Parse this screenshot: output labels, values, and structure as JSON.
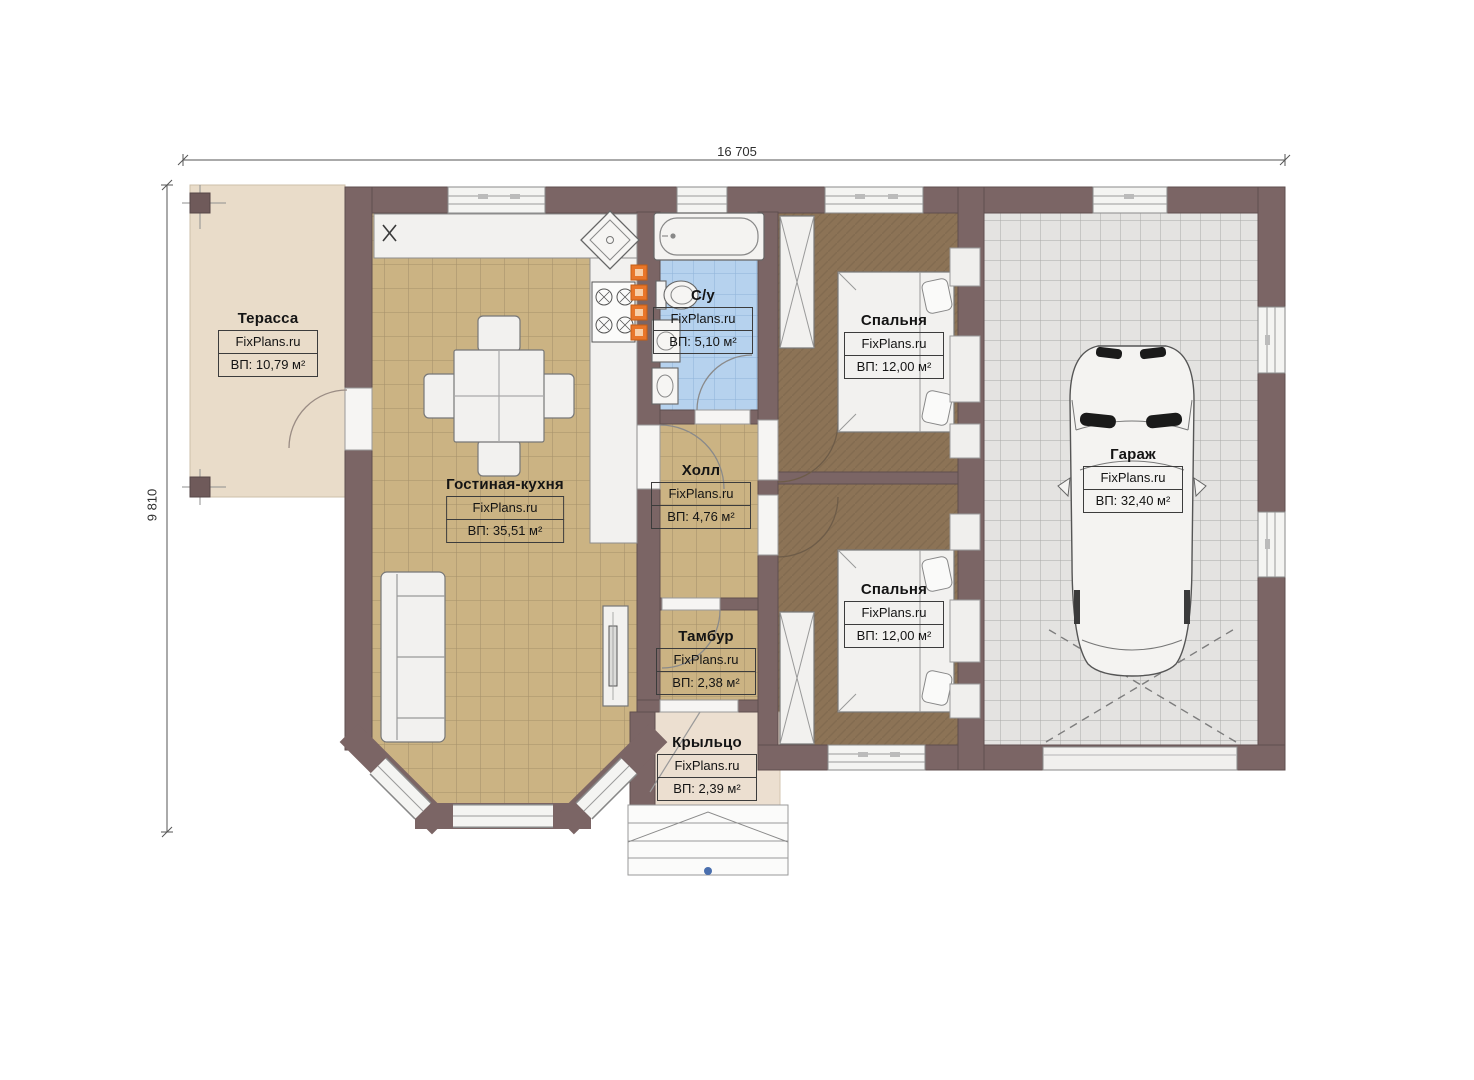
{
  "dimensions": {
    "width_label": "16 705",
    "height_label": "9 810"
  },
  "rooms": [
    {
      "id": "terrace",
      "name": "Терасса",
      "brand": "FixPlans.ru",
      "area": "ВП: 10,79 м²"
    },
    {
      "id": "living",
      "name": "Гостиная-кухня",
      "brand": "FixPlans.ru",
      "area": "ВП: 35,51 м²"
    },
    {
      "id": "bathroom",
      "name": "С/у",
      "brand": "FixPlans.ru",
      "area": "ВП: 5,10 м²"
    },
    {
      "id": "hall",
      "name": "Холл",
      "brand": "FixPlans.ru",
      "area": "ВП: 4,76 м²"
    },
    {
      "id": "bedroom1",
      "name": "Спальня",
      "brand": "FixPlans.ru",
      "area": "ВП: 12,00 м²"
    },
    {
      "id": "bedroom2",
      "name": "Спальня",
      "brand": "FixPlans.ru",
      "area": "ВП: 12,00 м²"
    },
    {
      "id": "tambur",
      "name": "Тамбур",
      "brand": "FixPlans.ru",
      "area": "ВП: 2,38 м²"
    },
    {
      "id": "porch",
      "name": "Крыльцо",
      "brand": "FixPlans.ru",
      "area": "ВП: 2,39 м²"
    },
    {
      "id": "garage",
      "name": "Гараж",
      "brand": "FixPlans.ru",
      "area": "ВП: 32,40 м²"
    }
  ],
  "markers": {
    "fridge_mark": "x"
  },
  "colors": {
    "wall": "#7b6565",
    "living_floor": "#cbb383",
    "bedroom_floor": "#8c7356",
    "bath_floor": "#b6d2ee",
    "garage_floor": "#e4e3e1",
    "terrace_floor": "#e9dcc9",
    "porch_floor": "#ecdfd0",
    "accent_orange": "#e8762a"
  }
}
